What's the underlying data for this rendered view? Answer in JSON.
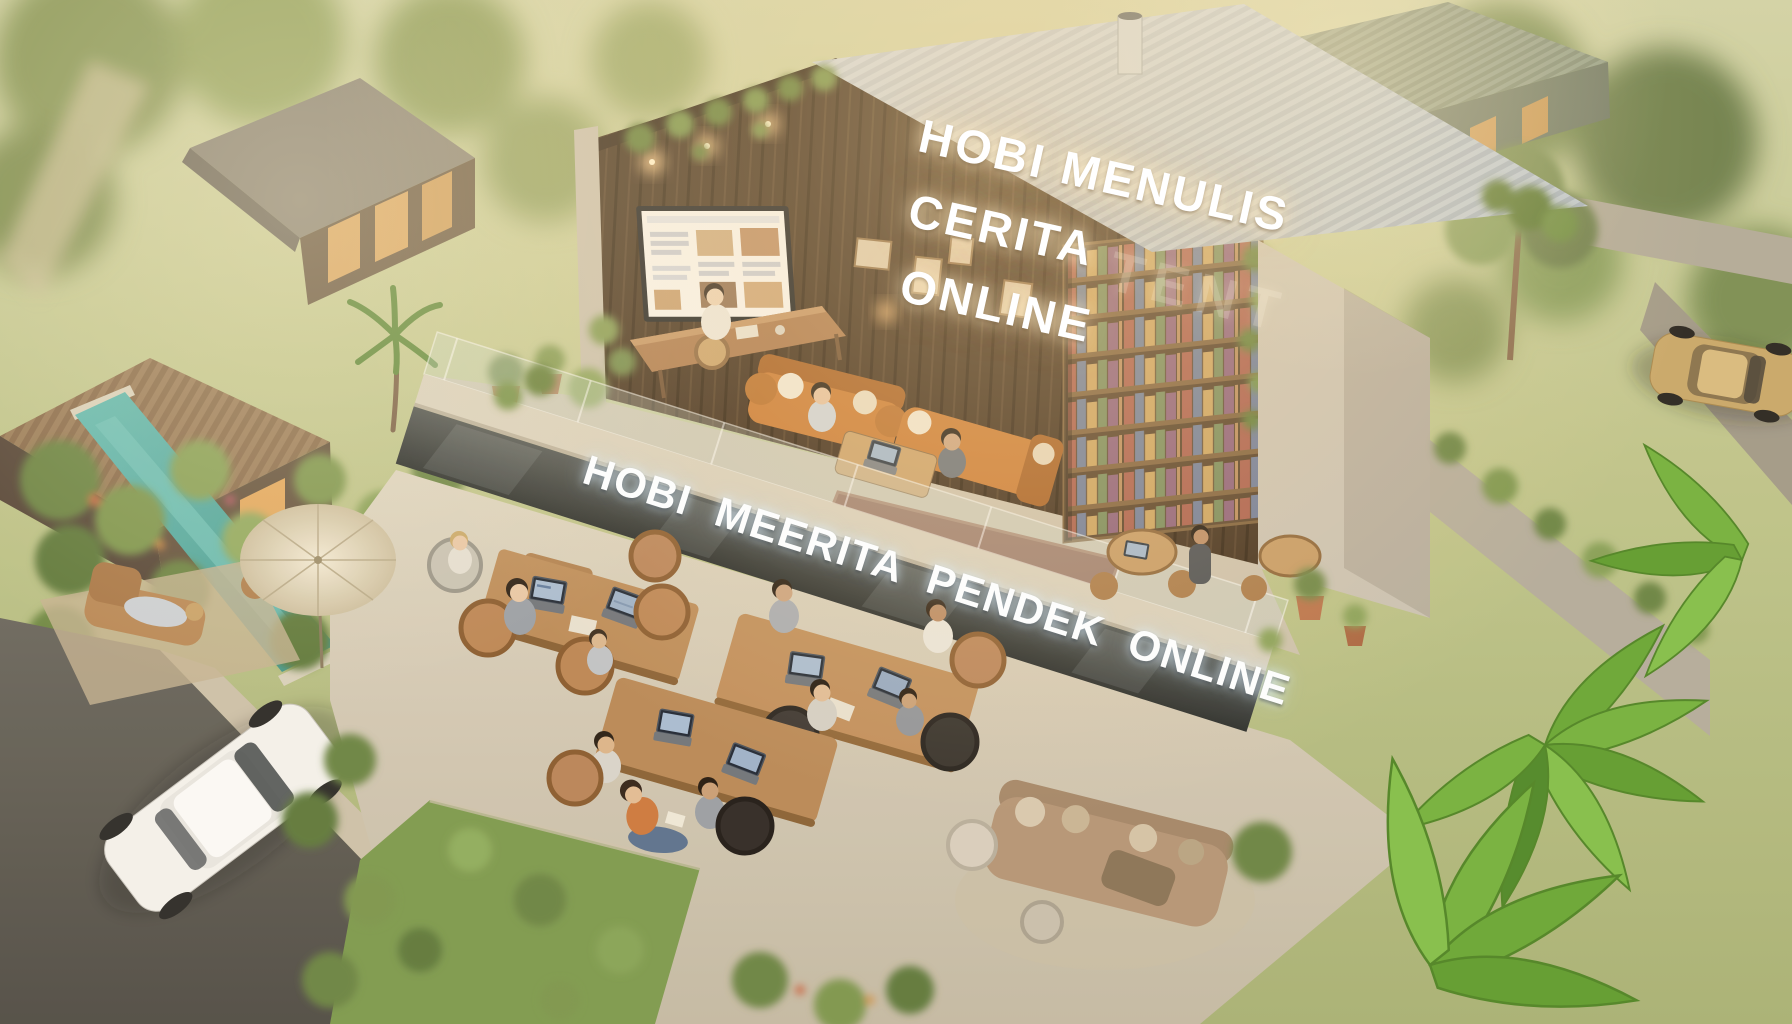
{
  "scene": {
    "type": "isometric-3d-render",
    "description": "Golden-hour aerial render of an open two-story writers' co-working house in a tropical village; people write on laptops at wooden tables, orange sofas and a bookshelf wall upstairs; glowing 3D sign letters on the wood wall and mezzanine edge.",
    "signs": {
      "upper_wall": {
        "line1": "HOBI MENULIS",
        "line2": "CERITA",
        "line3": "ONLINE",
        "ghost_text": "TENT"
      },
      "floor_band": {
        "text": "HOBI MEERITA PENDEK ONLINE"
      }
    },
    "palette": {
      "sign_white": "#ffffff",
      "wood_wall": "#45311f",
      "roof_metal": "#bdc8d1",
      "sofa_orange": "#c97a33",
      "concrete": "#d8d1c0",
      "pool_teal": "#4fa8a0",
      "foliage_green": "#76934c",
      "banana_green": "#69a836",
      "road_asphalt": "#5f5d55",
      "haze_gold": "#ffe3ac"
    }
  }
}
